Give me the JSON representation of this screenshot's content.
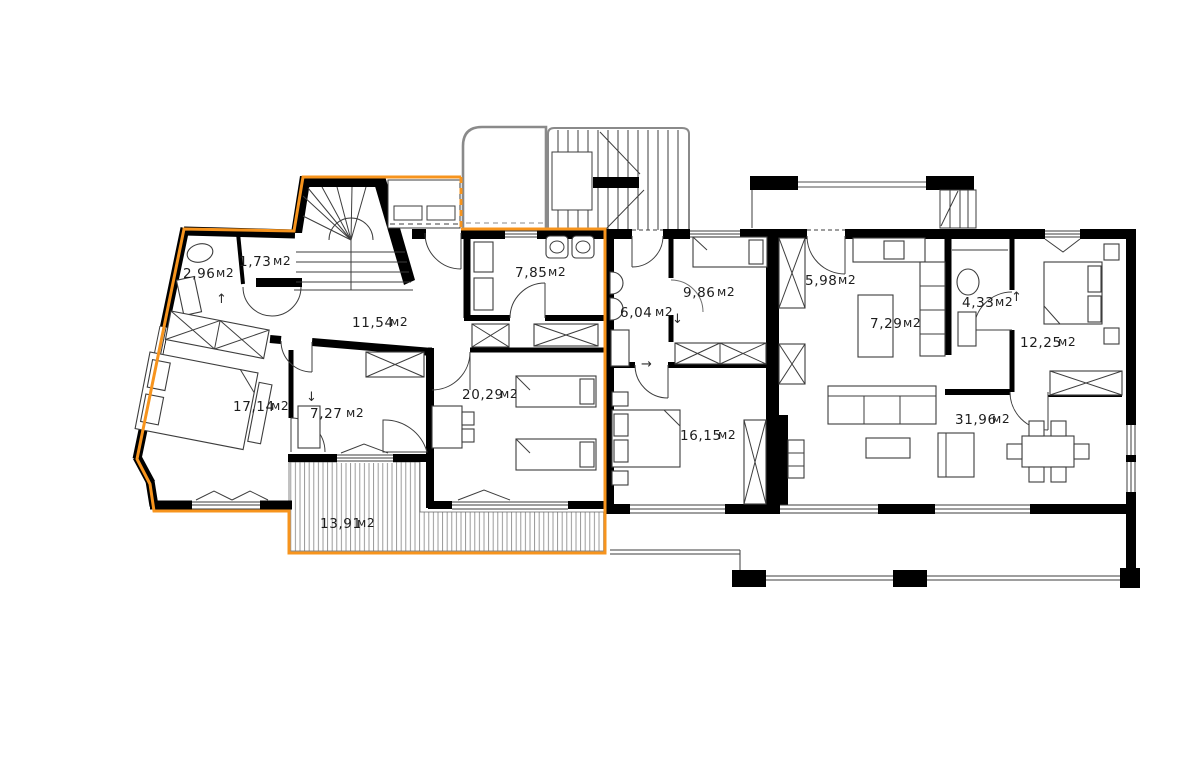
{
  "plan": {
    "highlight_color": "#F7941D",
    "wall_color": "#000000",
    "line_color": "#3d3d3d",
    "rooms": [
      {
        "name": "wc",
        "area": "2,96",
        "unit": "м2"
      },
      {
        "name": "hall-small",
        "area": "1,73",
        "unit": "м2"
      },
      {
        "name": "bathroom-left",
        "area": "7,85",
        "unit": "м2"
      },
      {
        "name": "hallway",
        "area": "11,54",
        "unit": "м2"
      },
      {
        "name": "bedroom-left",
        "area": "17,14",
        "unit": "м2"
      },
      {
        "name": "bathroom-small",
        "area": "7,27",
        "unit": "м2"
      },
      {
        "name": "kids-room",
        "area": "20,29",
        "unit": "м2"
      },
      {
        "name": "terrace",
        "area": "13,91",
        "unit": "м2"
      },
      {
        "name": "bathroom-mid",
        "area": "6,04",
        "unit": "м2"
      },
      {
        "name": "bedroom-mid-top",
        "area": "9,86",
        "unit": "м2"
      },
      {
        "name": "bedroom-mid",
        "area": "16,15",
        "unit": "м2"
      },
      {
        "name": "hall-right",
        "area": "5,98",
        "unit": "м2"
      },
      {
        "name": "kitchen",
        "area": "7,29",
        "unit": "м2"
      },
      {
        "name": "bathroom-right",
        "area": "4,33",
        "unit": "м2"
      },
      {
        "name": "bedroom-right",
        "area": "12,25",
        "unit": "м2"
      },
      {
        "name": "living-room",
        "area": "31,96",
        "unit": "м2"
      }
    ],
    "arrows": [
      {
        "name": "entry-up-left",
        "glyph": "↑"
      },
      {
        "name": "down-left",
        "glyph": "↓"
      },
      {
        "name": "down-mid",
        "glyph": "↓"
      },
      {
        "name": "right-mid",
        "glyph": "→"
      },
      {
        "name": "entry-up-right",
        "glyph": "↑"
      }
    ]
  }
}
